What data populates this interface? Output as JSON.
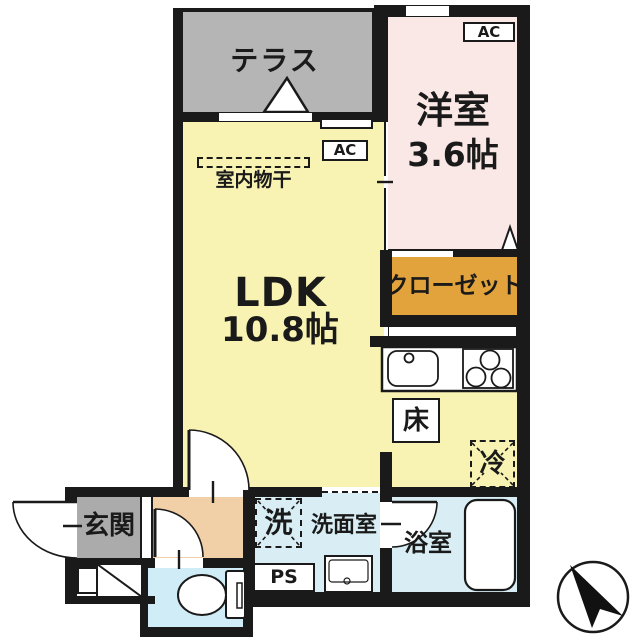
{
  "rooms": {
    "terrace": "テラス",
    "western_room": "洋室",
    "western_room_size": "3.6帖",
    "closet": "クローゼット",
    "ldk": "LDK",
    "ldk_size": "10.8帖",
    "indoor_drying": "室内物干",
    "entrance": "玄関",
    "washroom": "洗面室",
    "bathroom": "浴室"
  },
  "labels": {
    "ac": "AC",
    "floor_storage": "床",
    "refrigerator": "冷",
    "washer": "洗",
    "pipe_space": "PS"
  },
  "colors": {
    "wall": "#1a1a1a",
    "terrace_floor": "#b5b5b5",
    "western_room_floor": "#fae8e6",
    "closet_floor": "#e3a33c",
    "ldk_floor": "#f8f3b2",
    "entrance_floor": "#ababab",
    "hall_floor": "#f2d0a7",
    "wet_area_floor": "#d8eef4",
    "toilet_floor": "#d0ecf6"
  }
}
